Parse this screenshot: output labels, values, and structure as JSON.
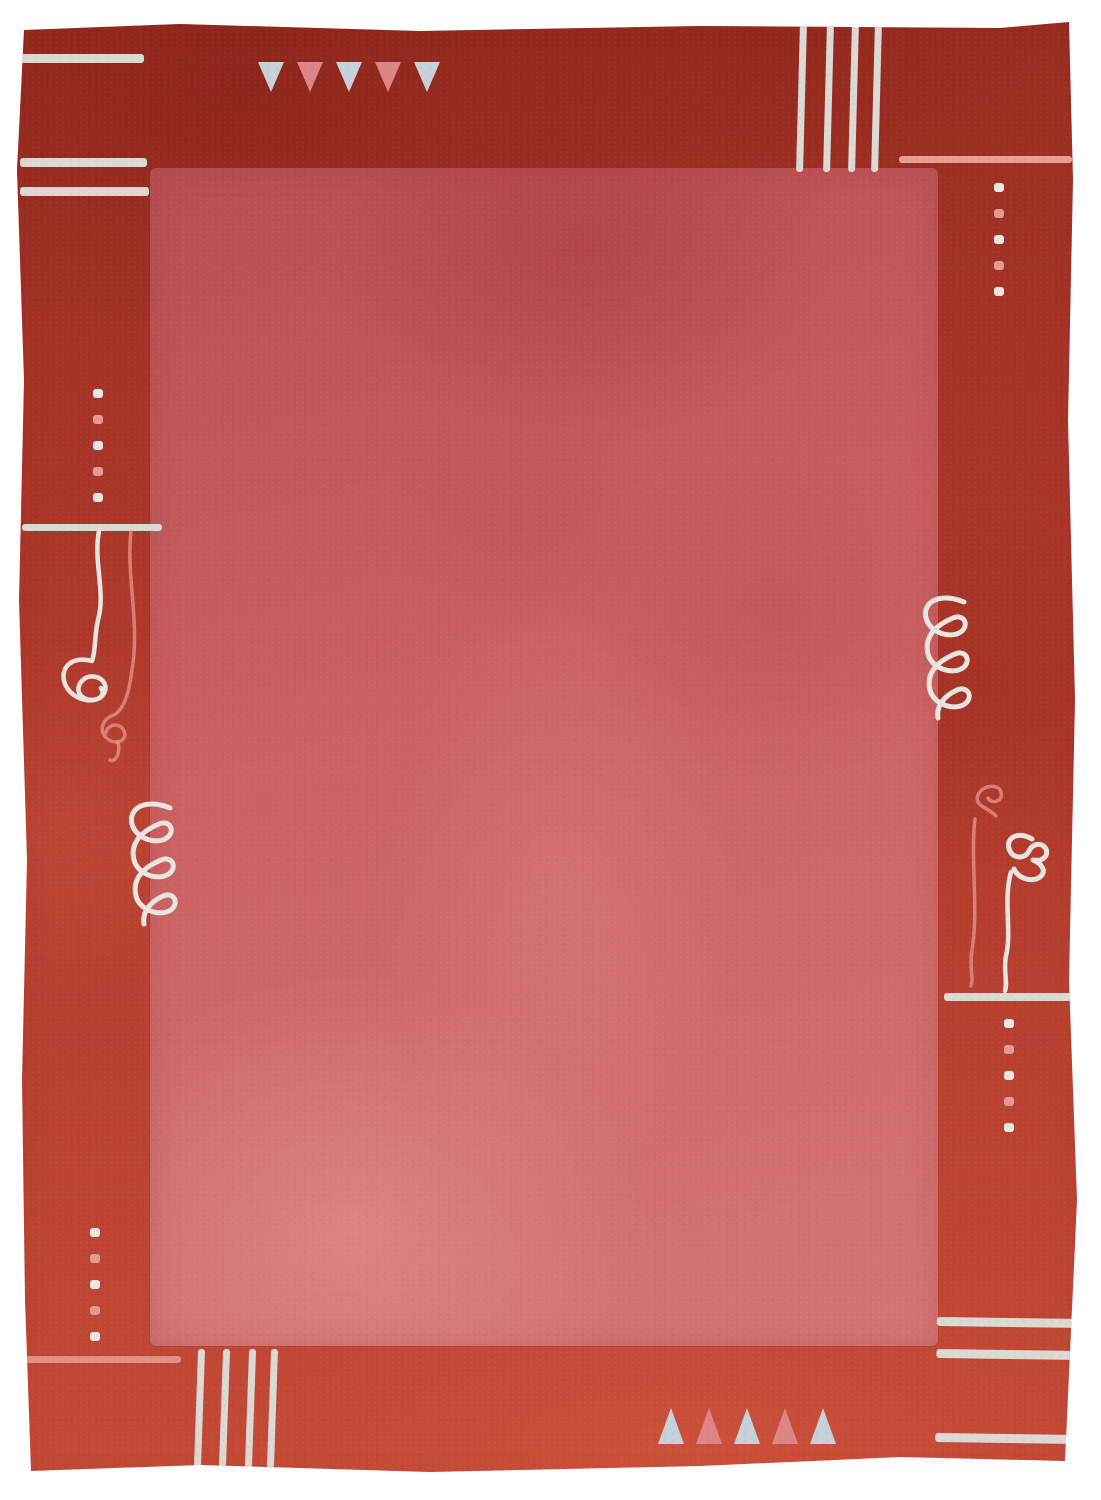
{
  "scene": {
    "description": "Photograph of a hand-knotted red wool area rug on a white background. A rose-red inner field is framed by a darker brick-red border decorated with silver-white and pink motifs: horizontal stripe groups in the top-left and bottom-right corners, vertical stripe groups in the top-right and bottom-left corners, a row of five downward triangles at the top, a row of five upward triangles at the bottom, four columns of five small dots, four short accent lines, two three-loop coil scribbles and two wavy embroidery squiggles ending in flower-like knots."
  },
  "colors": {
    "background": "#ffffff",
    "border_red": "#ae382a",
    "border_red_dark": "#9a2d21",
    "border_red_light": "#c44a36",
    "field_red": "#ca5f61",
    "field_red_dark": "#b84e52",
    "field_red_light": "#d47476",
    "stripe_white": "#dcd9d4",
    "motif_blue_white": "#c6d1da",
    "motif_pink": "#dd8487",
    "dot_white": "#eae7e3",
    "dot_pink": "#e29a95",
    "line_white": "#dcdad5",
    "line_pink": "#e89e93",
    "scribble_white": "#e8e5e1",
    "scribble_pink": "#e59a91"
  },
  "motifs": {
    "top_triangles": {
      "direction": "down",
      "count": 5,
      "colors": [
        "white",
        "pink",
        "white",
        "pink",
        "white"
      ]
    },
    "bottom_triangles": {
      "direction": "up",
      "count": 5,
      "colors": [
        "white",
        "pink",
        "white",
        "pink",
        "white"
      ]
    },
    "corner_stripes": {
      "top_left": {
        "orientation": "horizontal",
        "count": 3,
        "color": "white"
      },
      "top_right": {
        "orientation": "vertical",
        "count": 4,
        "color": "white"
      },
      "bottom_left": {
        "orientation": "vertical",
        "count": 4,
        "color": "white"
      },
      "bottom_right": {
        "orientation": "horizontal",
        "count": 3,
        "color": "white"
      }
    },
    "dot_columns": {
      "right_top": {
        "count": 5,
        "colors": [
          "white",
          "pink",
          "white",
          "pink",
          "white"
        ]
      },
      "left_upper": {
        "count": 5,
        "colors": [
          "white",
          "pink",
          "white",
          "pink",
          "white"
        ]
      },
      "right_lower": {
        "count": 5,
        "colors": [
          "white",
          "pink",
          "white",
          "pink",
          "white"
        ]
      },
      "left_lower": {
        "count": 5,
        "colors": [
          "white",
          "pink",
          "white",
          "pink",
          "white"
        ]
      }
    },
    "side_lines": {
      "top_right": {
        "color": "pink"
      },
      "left_middle": {
        "color": "white"
      },
      "right_lower": {
        "color": "white"
      },
      "bottom_left": {
        "color": "pink"
      }
    },
    "loop_coils": {
      "left_lower": {
        "loops": 3,
        "color": "white"
      },
      "right_middle": {
        "loops": 3,
        "color": "white"
      }
    },
    "squiggles": {
      "left": {
        "strands": [
          "white",
          "pink"
        ],
        "ends_in": "flower-knot"
      },
      "right": {
        "strands": [
          "pink",
          "white"
        ],
        "ends_in": "flower-knot"
      }
    }
  }
}
